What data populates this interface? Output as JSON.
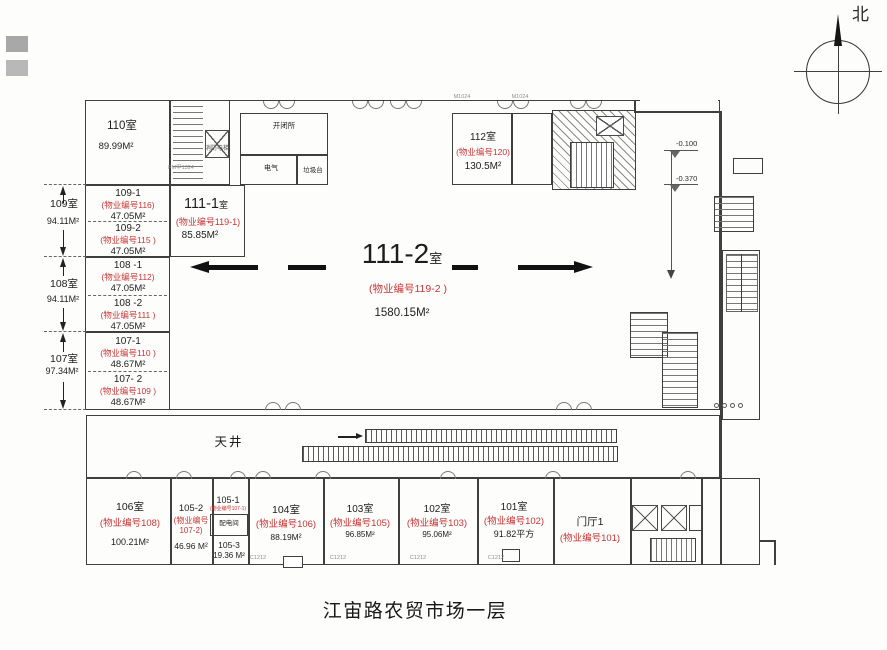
{
  "title": "江宙路农贸市场一层",
  "compass": {
    "label": "北"
  },
  "colors": {
    "red_accent": "#c73535",
    "wall": "#3f3f3f",
    "arrow_black": "#111111"
  },
  "hall": {
    "name": "111-2",
    "suffix": "室",
    "prop": "(物业编号119-2 )",
    "area": "1580.15M²"
  },
  "r111_1": {
    "name": "111-1",
    "suffix": "室",
    "prop": "(物业编号119-1)",
    "area": "85.85M²"
  },
  "r112": {
    "name": "112室",
    "prop": "(物业编号120)",
    "area": "130.5M²"
  },
  "upper_left_rooms": {
    "r110": {
      "name": "110室",
      "area": "89.99M²"
    },
    "r109_1": {
      "name": "109-1",
      "prop": "(物业编号116)",
      "area": "47.05M²"
    },
    "r109_2": {
      "name": "109-2",
      "prop": "(物业编号115 )",
      "area": "47.05M²"
    },
    "r108_1": {
      "name": "108 -1",
      "prop": "(物业编号112)",
      "area": "47.05M²"
    },
    "r108_2": {
      "name": "108 -2",
      "prop": "(物业编号111 )",
      "area": "47.05M²"
    },
    "r107_1": {
      "name": "107-1",
      "prop": "(物业编号110 )",
      "area": "48.67M²"
    },
    "r107_2": {
      "name": "107- 2",
      "prop": "(物业编号109 )",
      "area": "48.67M²"
    }
  },
  "side_dims": [
    {
      "room": "109室",
      "area": "94.11M²"
    },
    {
      "room": "108室",
      "area": "94.11M²"
    },
    {
      "room": "107室",
      "area": "97.34M²"
    }
  ],
  "service": {
    "switch_station": "开闭所",
    "electrical": "电气",
    "refuse": "垃圾台",
    "fire_elevator": "消防电梯",
    "distribution": "配电间",
    "courtyard": "天井"
  },
  "levels": {
    "l1": "-0.100",
    "l2": "-0.370"
  },
  "bottom_rooms": {
    "r106": {
      "name": "106室",
      "prop": "(物业编号108)",
      "area": "100.21M²"
    },
    "r105_2": {
      "name": "105-2",
      "prop_l1": "(物业编号",
      "prop_l2": "107-2)",
      "area": "46.96 M²"
    },
    "r105_1": {
      "name": "105-1",
      "prop": "(物业编号107-1)"
    },
    "r105_3": {
      "name": "105-3",
      "area": "19.36 M²"
    },
    "r104": {
      "name": "104室",
      "prop": "(物业编号106)",
      "area": "88.19M²"
    },
    "r103": {
      "name": "103室",
      "prop": "(物业编号105)",
      "area": "96.85M²"
    },
    "r102": {
      "name": "102室",
      "prop": "(物业编号103)",
      "area": "95.06M²"
    },
    "r101": {
      "name": "101室",
      "prop": "(物业编号102)",
      "area": "91.82平方"
    },
    "lobby": {
      "name": "门厅1",
      "prop": "(物业编号101)"
    }
  },
  "door_codes": {
    "m": "M1024",
    "fm": "FM甲1324",
    "c": "C1212"
  }
}
